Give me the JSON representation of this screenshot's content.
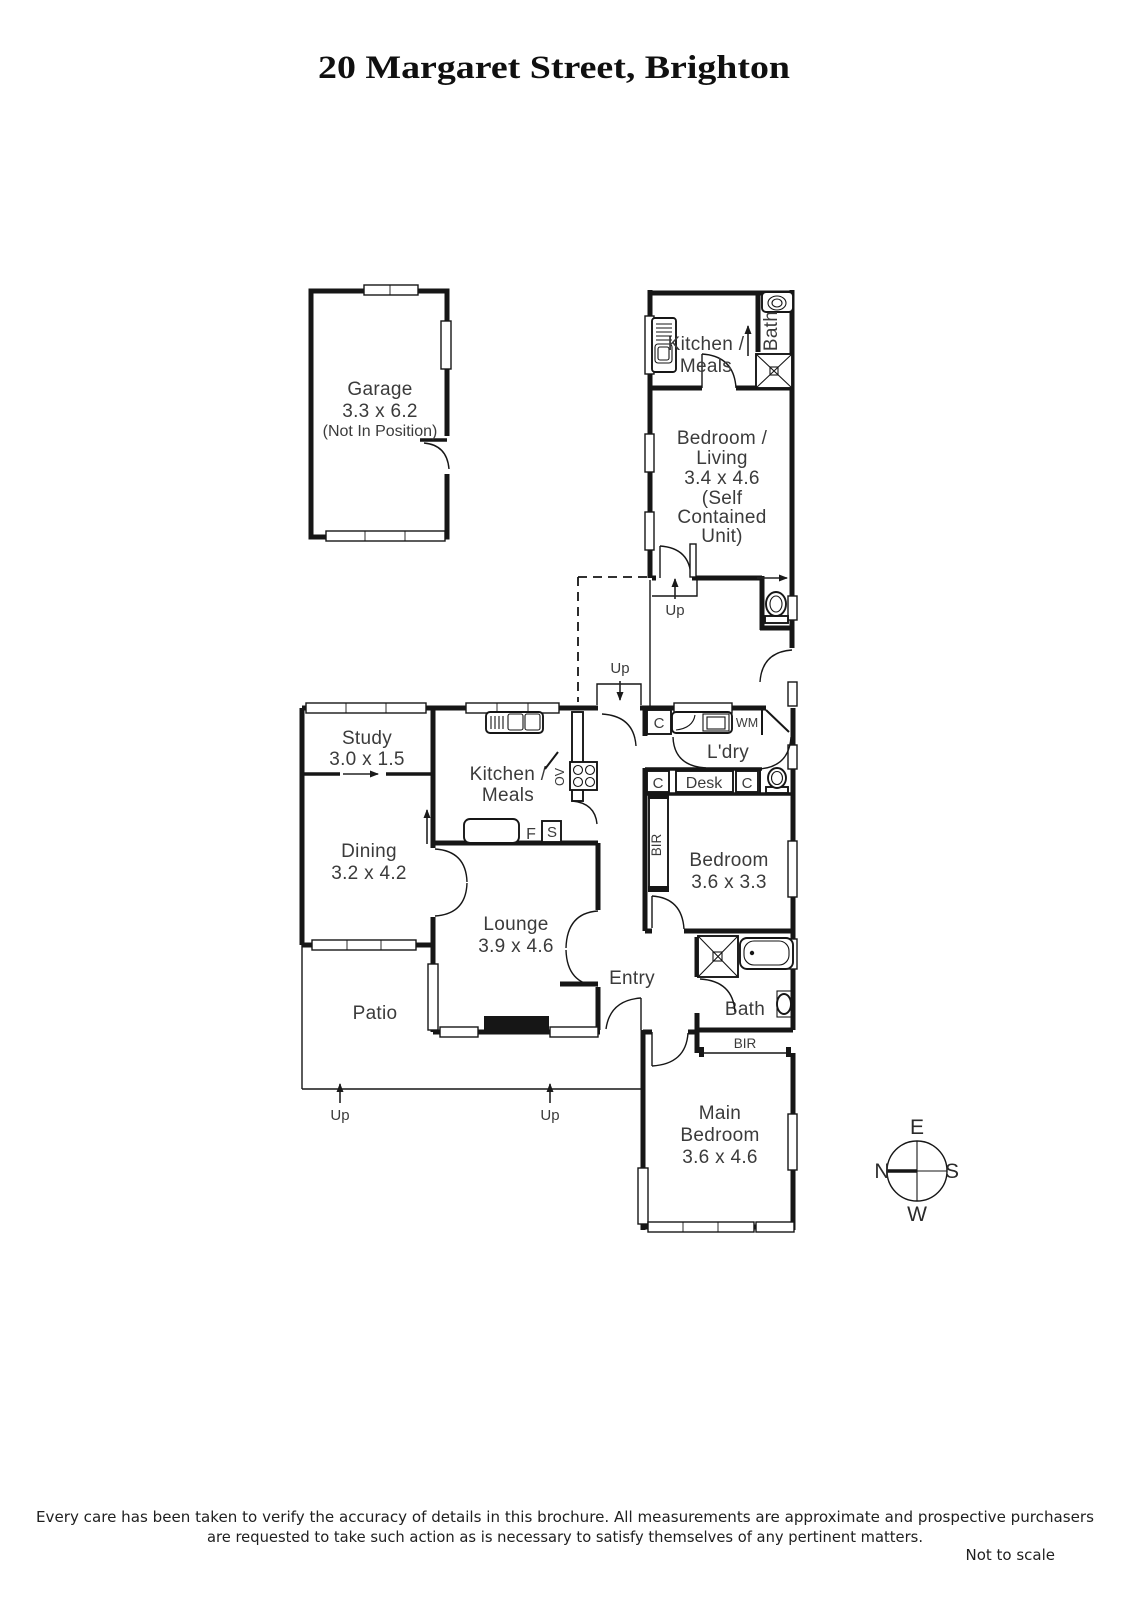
{
  "title": "20 Margaret Street, Brighton",
  "garage": {
    "name": "Garage",
    "dims": "3.3 x 6.2",
    "note": "(Not In Position)"
  },
  "unit": {
    "kitchen_l1": "Kitchen /",
    "kitchen_l2": "Meals",
    "bath": "Bath",
    "bedliving_l1": "Bedroom /",
    "bedliving_l2": "Living",
    "bedliving_l3": "3.4 x 4.6",
    "bedliving_l4": "(Self",
    "bedliving_l5": "Contained",
    "bedliving_l6": "Unit)"
  },
  "house": {
    "study_name": "Study",
    "study_dims": "3.0 x 1.5",
    "kitchen_l1": "Kitchen /",
    "kitchen_l2": "Meals",
    "dining_name": "Dining",
    "dining_dims": "3.2 x 4.2",
    "lounge_name": "Lounge",
    "lounge_dims": "3.9 x 4.6",
    "bedroom_name": "Bedroom",
    "bedroom_dims": "3.6 x 3.3",
    "main_bedroom_l1": "Main",
    "main_bedroom_l2": "Bedroom",
    "main_bedroom_dims": "3.6 x 4.6",
    "bath": "Bath",
    "entry": "Entry",
    "patio": "Patio",
    "laundry": "L'dry",
    "desk": "Desk"
  },
  "tags": {
    "up": "Up",
    "c": "C",
    "wm": "WM",
    "bir": "BIR",
    "ov": "OV",
    "f": "F",
    "s": "S"
  },
  "compass": {
    "e": "E",
    "s": "S",
    "w": "W",
    "n": "N"
  },
  "footer": {
    "line1": "Every care has been taken to verify the accuracy of details in this brochure.  All measurements are approximate and prospective purchasers",
    "line2": "are requested to take such action as is necessary to satisfy themselves of any pertinent matters.",
    "scale": "Not to scale"
  }
}
